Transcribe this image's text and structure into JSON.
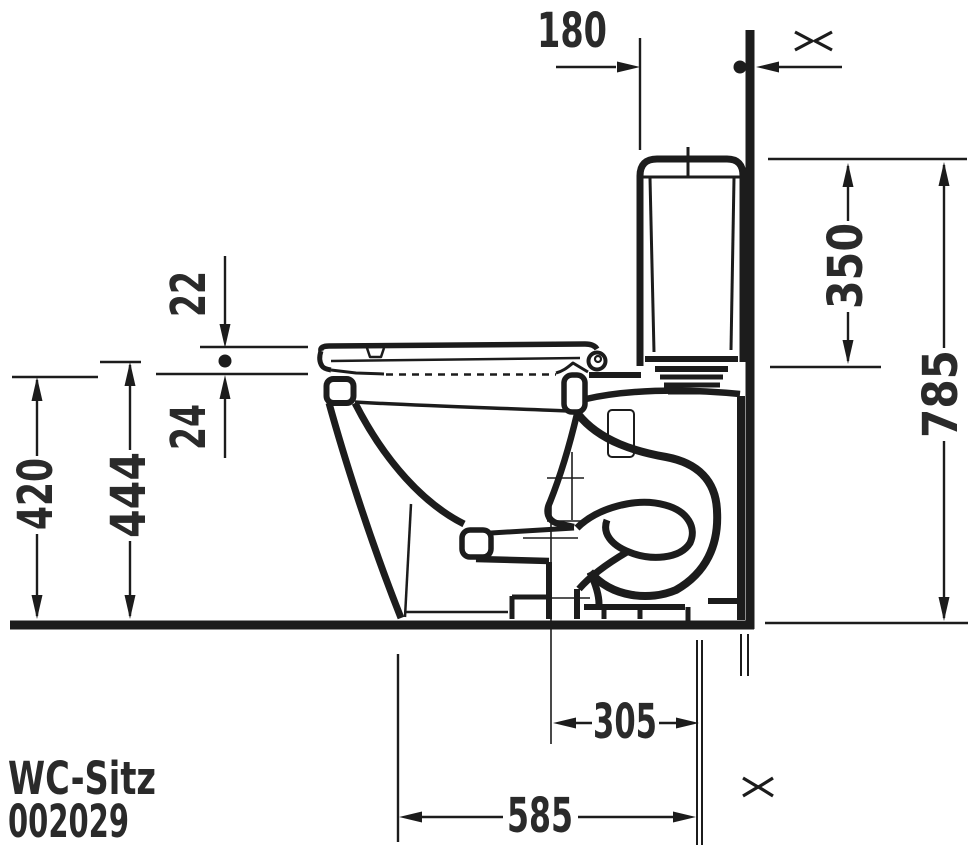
{
  "drawing": {
    "title": "WC-Sitz",
    "product_code": "002029",
    "dimensions": {
      "wall_to_cistern": "180",
      "cistern_height": "350",
      "overall_height": "785",
      "seat_thickness": "22",
      "seat_to_rim": "24",
      "rim_height": "420",
      "hinge_height": "444",
      "outlet_offset": "305",
      "overall_depth": "585"
    },
    "symbols": {
      "wall_break": "><"
    },
    "colors": {
      "line": "#1c1c1c",
      "text": "#2a2a2a",
      "background": "#ffffff"
    }
  }
}
